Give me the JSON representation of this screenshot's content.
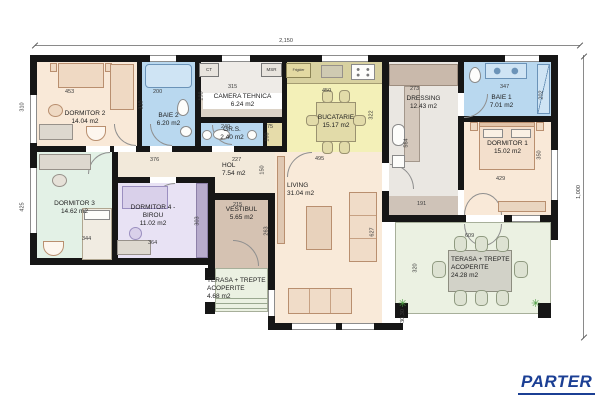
{
  "title": "PARTER",
  "accent_color": "#1b3f94",
  "overall_dims": {
    "top": "2,150",
    "right": "1,000"
  },
  "rooms": [
    {
      "id": "dormitor-2",
      "label": "DORMITOR 2",
      "area": "14.04 m2"
    },
    {
      "id": "baie-2",
      "label": "BAIE 2",
      "area": "6.20 m2"
    },
    {
      "id": "camera-tehnica",
      "label": "CAMERA TEHNICA",
      "area": "6.24 m2"
    },
    {
      "id": "gr-s",
      "label": "GR.S.",
      "area": "2.40 m2"
    },
    {
      "id": "bucatarie",
      "label": "BUCATARIE",
      "area": "15.17 m2"
    },
    {
      "id": "dressing",
      "label": "DRESSING",
      "area": "12.43 m2"
    },
    {
      "id": "baie-1",
      "label": "BAIE 1",
      "area": "7.01 m2"
    },
    {
      "id": "dormitor-1",
      "label": "DORMITOR 1",
      "area": "15.02 m2"
    },
    {
      "id": "hol",
      "label": "HOL",
      "area": "7.54 m2"
    },
    {
      "id": "living",
      "label": "LIVING",
      "area": "31.04 m2"
    },
    {
      "id": "dormitor-3",
      "label": "DORMITOR 3",
      "area": "14.62 m2"
    },
    {
      "id": "dormitor-4",
      "label": "DORMITOR 4 - BIROU",
      "area": "11.02 m2"
    },
    {
      "id": "vestibul",
      "label": "VESTIBUL",
      "area": "5.65 m2"
    },
    {
      "id": "terasa-mica",
      "label": "TERASA + TREPTE ACOPERITE",
      "area": "4.68 m2"
    },
    {
      "id": "terasa-mare",
      "label": "TERASA + TREPTE ACOPERITE",
      "area": "24.28 m2"
    }
  ],
  "appliances": {
    "ct": "CT",
    "msr": "MSR",
    "frigider": "Frigider"
  },
  "dims": {
    "top": "2,150",
    "right": "1,000",
    "d2_w": "453",
    "d2_h": "310",
    "baie2_w": "200",
    "baie2_h": "310",
    "ct_w": "315",
    "ct_h": "198",
    "grs_w": "240",
    "grs_e_w": "75",
    "grs_e_h": "100",
    "buc_w": "450",
    "buc_h": "322",
    "dres_w": "273",
    "dres_h": "564",
    "baie1_w": "347",
    "baie1_h": "202",
    "d1_w": "429",
    "d1_h": "350",
    "hol_w1": "376",
    "hol_w2": "227",
    "hol_h": "150",
    "liv_w": "495",
    "liv_h": "627",
    "nook_w": "191",
    "d3_h": "425",
    "d3_w": "344",
    "d4_w": "364",
    "d4_h": "303",
    "vest_w": "215",
    "vest_h": "263",
    "ter_w": "609",
    "ter_h": "320",
    "ter_step": "30,30"
  }
}
